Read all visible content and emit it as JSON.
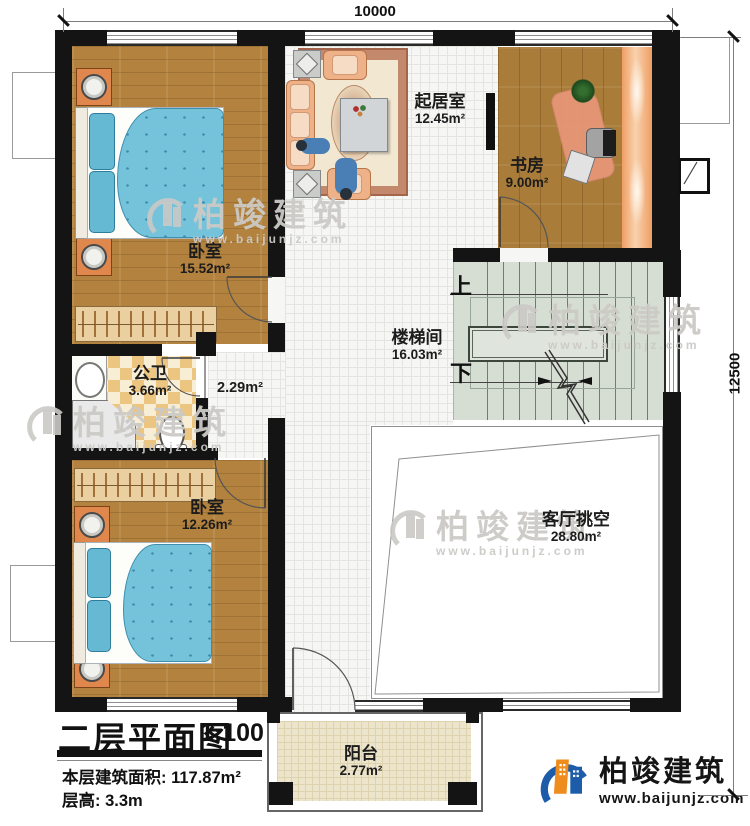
{
  "dimensions": {
    "width": "10000",
    "height": "12500"
  },
  "rooms": {
    "living": {
      "name": "起居室",
      "area": "12.45m²"
    },
    "study": {
      "name": "书房",
      "area": "9.00m²"
    },
    "bedroom_top": {
      "name": "卧室",
      "area": "15.52m²"
    },
    "stairwell": {
      "name": "楼梯间",
      "area": "16.03m²"
    },
    "bathroom": {
      "name": "公卫",
      "area": "3.66m²"
    },
    "corridor": {
      "area": "2.29m²"
    },
    "bedroom_bottom": {
      "name": "卧室",
      "area": "12.26m²"
    },
    "void": {
      "name": "客厅挑空",
      "area": "28.80m²"
    },
    "balcony": {
      "name": "阳台",
      "area": "2.77m²"
    }
  },
  "stairs": {
    "up_label": "上",
    "down_label": "下"
  },
  "title_block": {
    "title": "二层平面图",
    "scale": "1:100",
    "area_label": "本层建筑面积:",
    "area_value": "117.87m²",
    "height_label": "层高:",
    "height_value": "3.3m"
  },
  "brand": {
    "name": "柏竣建筑",
    "website": "www.baijunjz.com"
  },
  "watermark": {
    "name": "柏竣建筑",
    "website": "www.baijunjz.com"
  },
  "colors": {
    "wall": "#141414",
    "wood_floor": "#b2823e",
    "tile": "#f6f6f4",
    "stair_floor": "#d6ded4",
    "bed_blue": "#74c3da",
    "nightstand_orange": "#e0874e",
    "bath_checker": "#ecc580",
    "balcony_floor": "#ece4cb",
    "brand_blue": "#1c5ca8",
    "brand_orange": "#ef8c1e"
  }
}
